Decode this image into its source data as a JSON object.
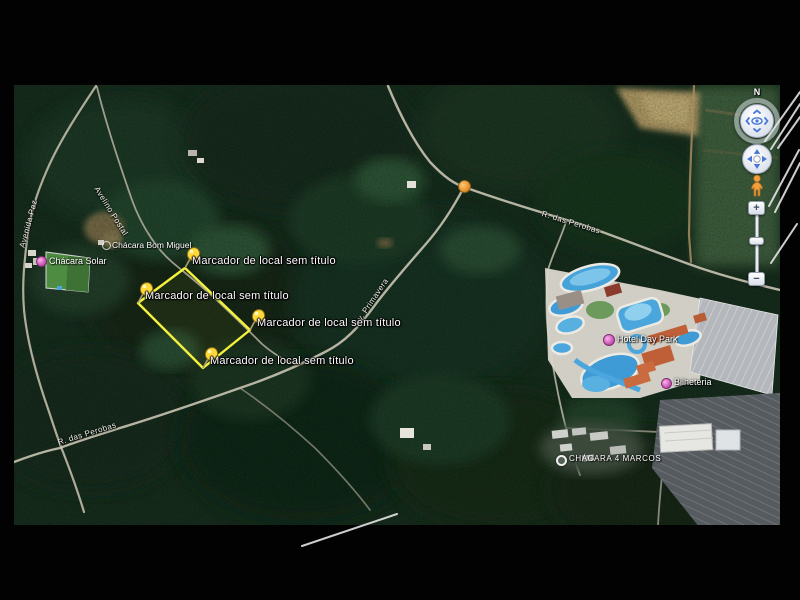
{
  "markers": [
    {
      "label": "Marcador de local sem título"
    },
    {
      "label": "Marcador de local sem título"
    },
    {
      "label": "Marcador de local sem título"
    },
    {
      "label": "Marcador de local sem título"
    }
  ],
  "places": {
    "bom_miguel": "Chácara Bom Miguel",
    "solar": "Chácara Solar",
    "hotel": "Hotel Day Park",
    "bilheteria": "Bilheteria",
    "marcos": "CHÁCARA 4 MARCOS"
  },
  "roads": {
    "paz": "Avenida Paz",
    "postal": "Avelino Postal",
    "primavera": "Av. Primavera",
    "perobas_upper": "R. das Perobas",
    "perobas_lower": "R. das Perobas"
  },
  "nav": {
    "north": "N",
    "zoom_in": "+",
    "zoom_out": "−"
  },
  "colors": {
    "selection_polygon": "#f4f23c",
    "pushpin": "#ffd83a",
    "poi_pink": "#c857b4",
    "junction_orange": "#e8922a",
    "marker_text": "#ffffff"
  }
}
